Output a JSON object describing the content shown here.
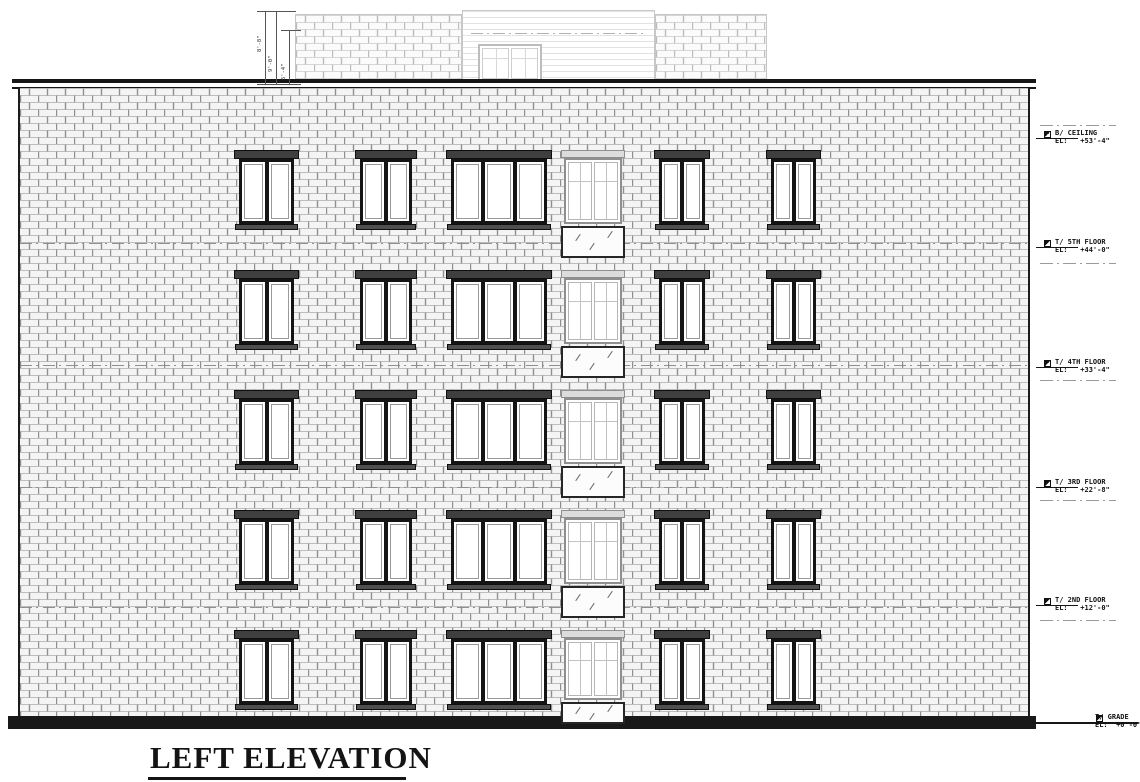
{
  "title": {
    "text": "LEFT ELEVATION"
  },
  "colors": {
    "ink": "#161616",
    "brick_field": "#f4f4f4",
    "brick_joint_h": "#bdbdbd",
    "brick_joint_v": "#8f8f8f",
    "bulkhead_brick_joint_h": "#d6d6d6",
    "bulkhead_brick_joint_v": "#bcbcbc",
    "light_line": "#c2c2c2",
    "paper": "#ffffff"
  },
  "markers": [
    {
      "name": "B/ CEILING",
      "el": "EL:   +53'-4\"",
      "y": 138,
      "dash_y": 125
    },
    {
      "name": "T/ 5TH FLOOR",
      "el": "EL:   +44'-0\"",
      "y": 247,
      "dash_y": 263
    },
    {
      "name": "T/ 4TH FLOOR",
      "el": "EL:   +33'-4\"",
      "y": 367,
      "dash_y": 380
    },
    {
      "name": "T/ 3RD FLOOR",
      "el": "EL:   +22'-8\"",
      "y": 487,
      "dash_y": 500
    },
    {
      "name": "T/ 2ND FLOOR",
      "el": "EL:   +12'-0\"",
      "y": 605,
      "dash_y": 620
    },
    {
      "name": "T/ GRADE",
      "el": "EL:  +0'-0\"",
      "y": 722,
      "long_line": true
    }
  ],
  "marker_layout": {
    "line_x1": 1036,
    "line_w": 42,
    "sym_x": 1044,
    "text_x": 1055,
    "dash_x1": 1040,
    "dash_w": 76,
    "grade_line_x1": 1030,
    "grade_line_w": 108,
    "grade_sym_x": 1096,
    "grade_text_x": 1095
  },
  "dimensions": {
    "vlines": [
      {
        "x": 265,
        "y1": 11,
        "y2": 84,
        "label": "8'-8\"",
        "lx": 257,
        "ly": 52
      },
      {
        "x": 276,
        "y1": 11,
        "y2": 84,
        "label": "9'-0\"",
        "lx": 268,
        "ly": 72
      },
      {
        "x": 289,
        "y1": 30,
        "y2": 84,
        "label": "5'-4\"",
        "lx": 281,
        "ly": 80
      }
    ],
    "ticks": [
      {
        "x1": 257,
        "x2": 296,
        "y": 11
      },
      {
        "x1": 281,
        "x2": 301,
        "y": 30
      },
      {
        "x1": 257,
        "x2": 301,
        "y": 84
      }
    ]
  },
  "elevation": {
    "floor_dash_y": [
      243,
      365,
      487,
      607
    ],
    "rows_y": [
      150,
      270,
      390,
      510,
      630
    ],
    "window_columns": [
      {
        "x": 239,
        "w": 55,
        "panes": 2
      },
      {
        "x": 360,
        "w": 52,
        "panes": 2
      },
      {
        "x": 451,
        "w": 96,
        "panes": 3
      },
      {
        "x": 659,
        "w": 46,
        "panes": 2
      },
      {
        "x": 771,
        "w": 45,
        "panes": 2
      }
    ],
    "window": {
      "lintel_h": 9,
      "frame_h": 65,
      "sill_h": 6
    },
    "door_column": {
      "x": 564,
      "w": 58,
      "rows": [
        {
          "glass_h": 66,
          "slab_top": 76,
          "slab_h": 32
        },
        {
          "glass_h": 66,
          "slab_top": 76,
          "slab_h": 32
        },
        {
          "glass_h": 66,
          "slab_top": 76,
          "slab_h": 32
        },
        {
          "glass_h": 66,
          "slab_top": 76,
          "slab_h": 32
        },
        {
          "glass_h": 62,
          "slab_top": 72,
          "slab_h": 22
        }
      ]
    }
  }
}
